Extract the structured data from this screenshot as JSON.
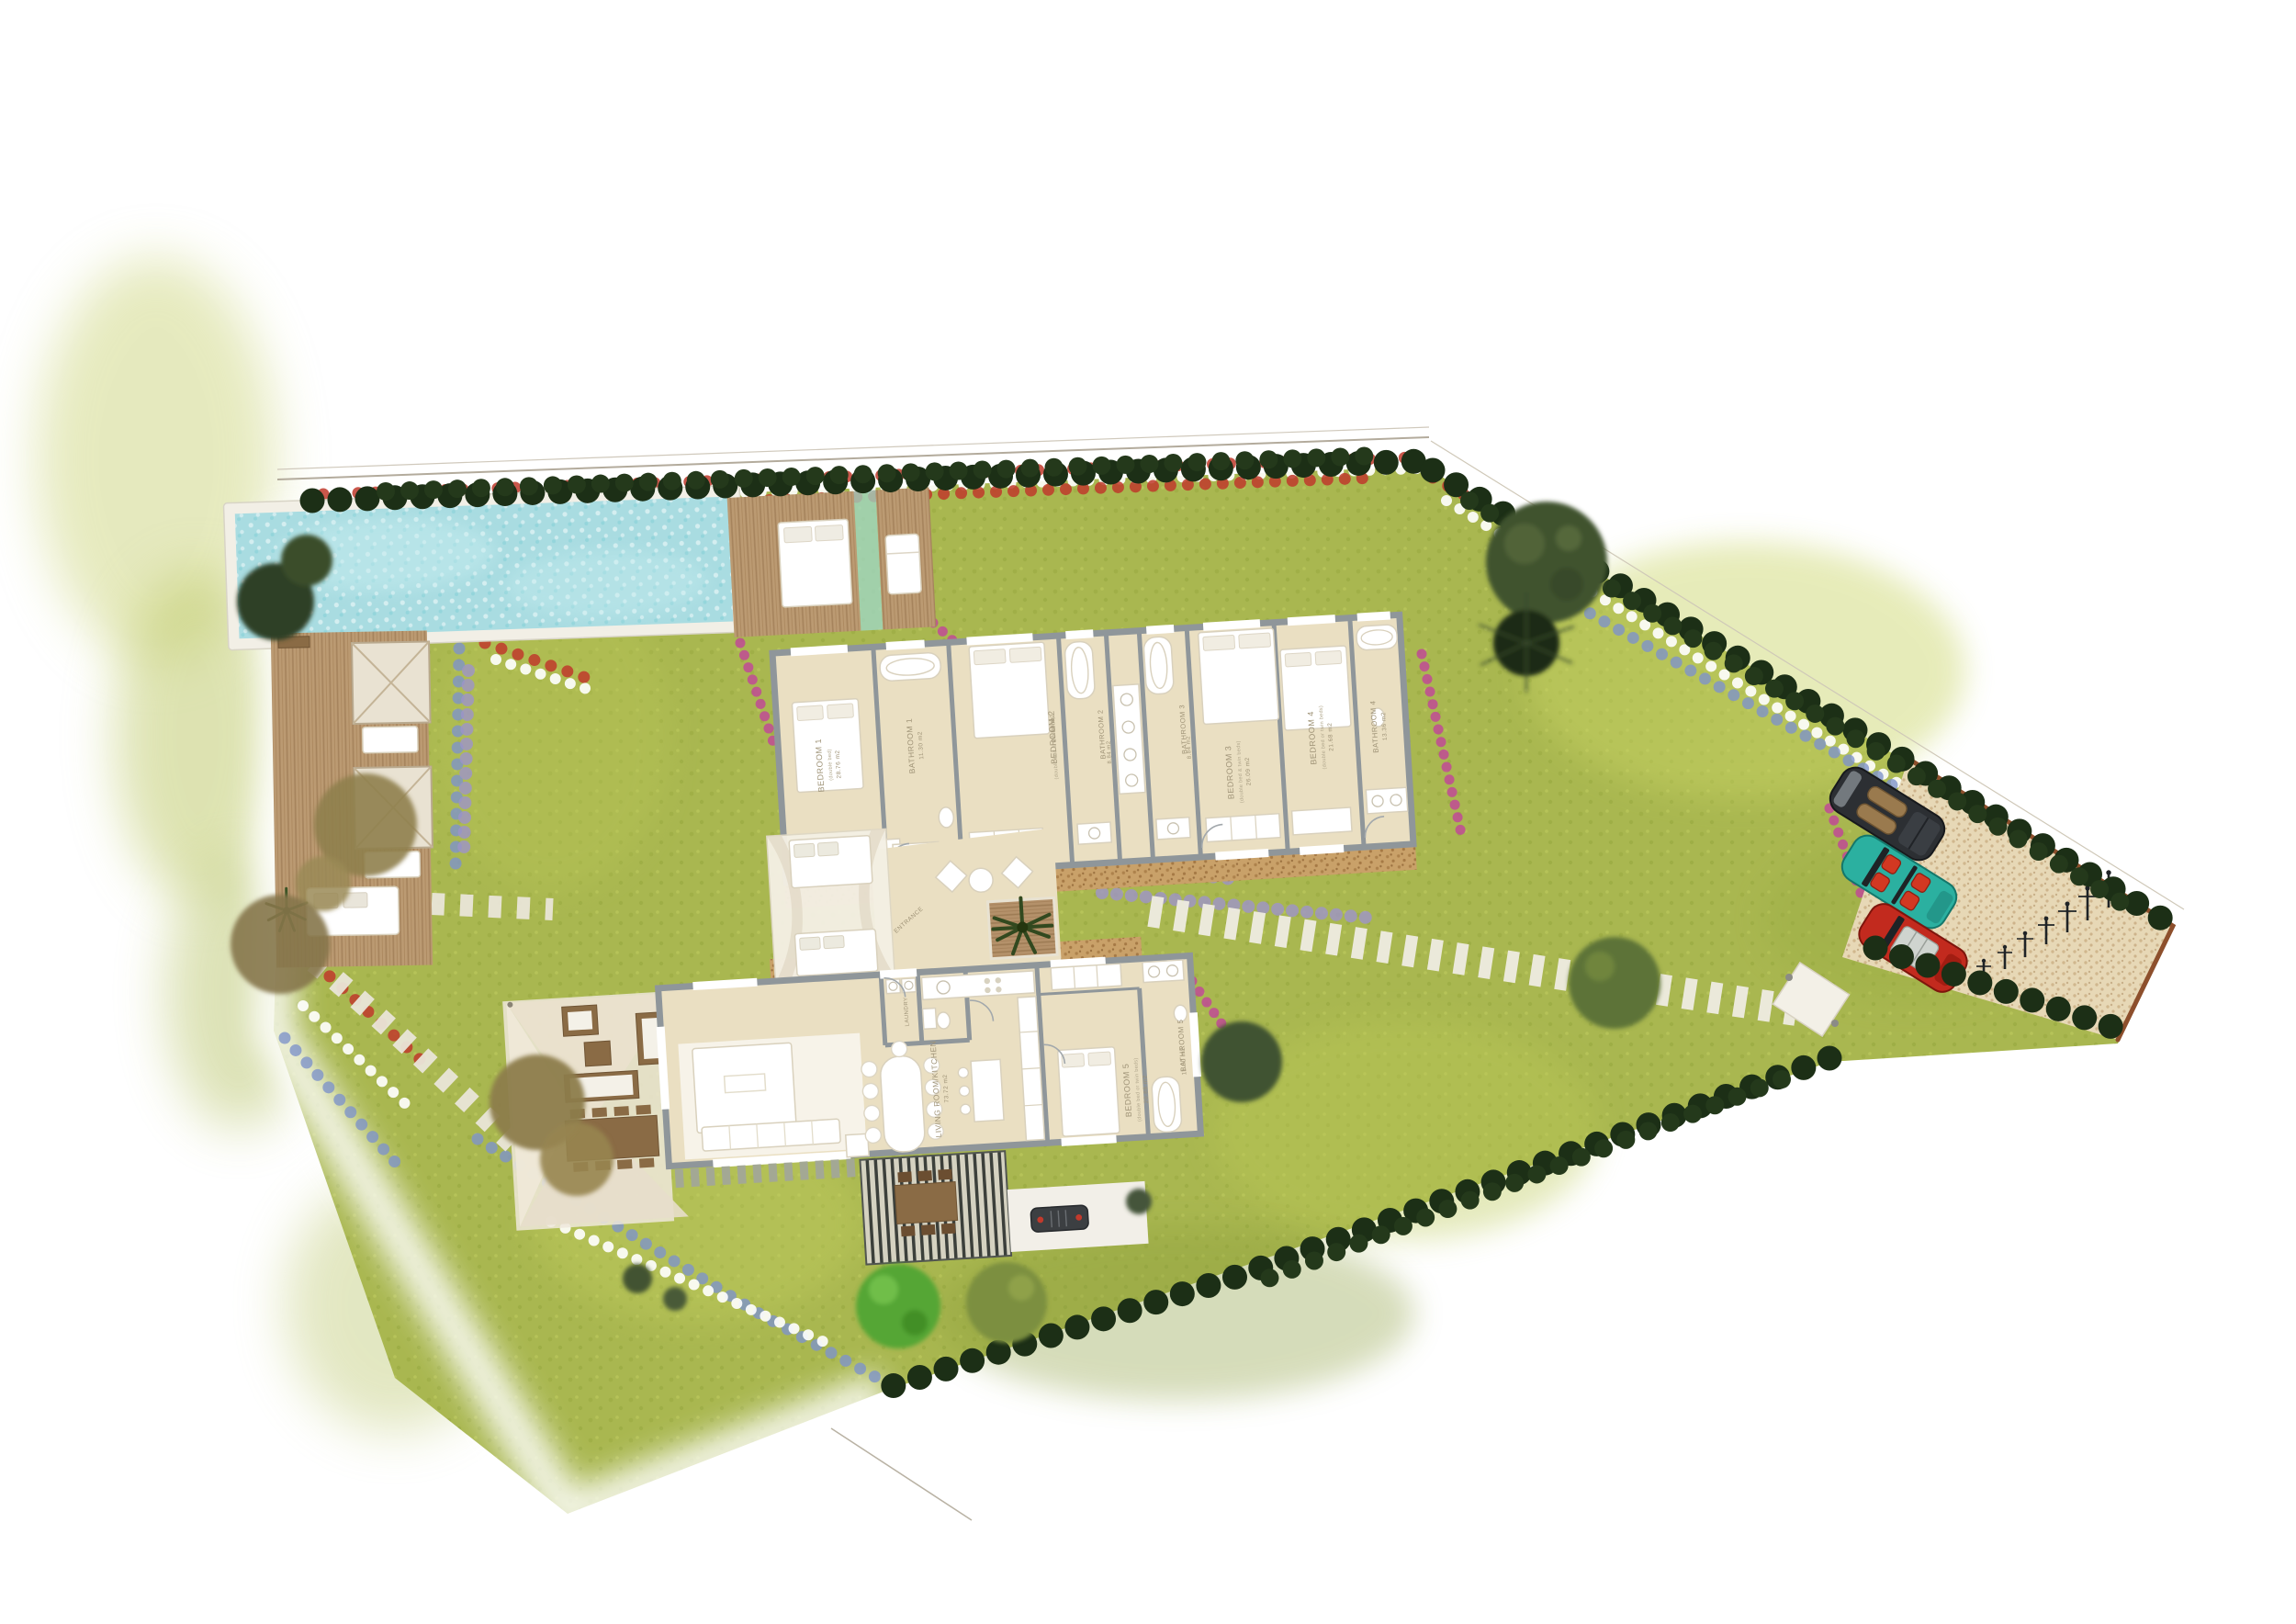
{
  "page": {
    "title": "Villa landscape site plan",
    "background": "#ffffff"
  },
  "plan": {
    "rooms": [
      {
        "id": "bedroom-1",
        "label": "BEDROOM 1",
        "detail": "(double bed)",
        "area": "28.76 m2"
      },
      {
        "id": "bathroom-1",
        "label": "BATHROOM 1",
        "detail": "",
        "area": "11.30 m2"
      },
      {
        "id": "bedroom-2",
        "label": "BEDROOM 2",
        "detail": "(double bed & twin beds)",
        "area": "27.88 m2"
      },
      {
        "id": "bathroom-2",
        "label": "BATHROOM 2",
        "detail": "",
        "area": "8.84 m2"
      },
      {
        "id": "bathroom-3",
        "label": "BATHROOM 3",
        "detail": "",
        "area": "8.84 m2"
      },
      {
        "id": "bedroom-3",
        "label": "BEDROOM 3",
        "detail": "(double bed & twin beds)",
        "area": "26.09 m2"
      },
      {
        "id": "bedroom-4",
        "label": "BEDROOM 4",
        "detail": "(double bed or twin beds)",
        "area": "21.68 m2"
      },
      {
        "id": "bathroom-4",
        "label": "BATHROOM 4",
        "detail": "",
        "area": "13.36 m2"
      },
      {
        "id": "bedroom-5",
        "label": "BEDROOM 5",
        "detail": "(double bed or twin beds)",
        "area": "20.88 m2"
      },
      {
        "id": "bathroom-5",
        "label": "BATHROOM 5",
        "detail": "",
        "area": "11.00 m2"
      },
      {
        "id": "living",
        "label": "LIVING ROOM/KITCHEN",
        "detail": "",
        "area": "73.72 m2"
      },
      {
        "id": "laundry",
        "label": "LAUNDRY",
        "detail": "",
        "area": ""
      },
      {
        "id": "entrance",
        "label": "ENTRANCE",
        "detail": "",
        "area": ""
      }
    ],
    "site_features": [
      "swimming-pool",
      "pool-deck-daybed",
      "sun-deck-cabanas",
      "outdoor-canopy-daybeds",
      "shade-sail-terrace",
      "outdoor-dining-pergola",
      "bbq-area",
      "parking-court",
      "stepping-stone-paths",
      "perimeter-hedge",
      "flower-borders",
      "olive-trees",
      "lawn"
    ],
    "cars": [
      {
        "name": "dark-grey-car",
        "color": "#2c2f33"
      },
      {
        "name": "teal-car",
        "color": "#2bb0a0"
      },
      {
        "name": "red-car",
        "color": "#c22a1e"
      }
    ],
    "colors": {
      "lawn": "#a9b750",
      "pool_water": "#a9dce1",
      "wood_deck": "#bb9a72",
      "floor": "#eadfc2",
      "wall": "#8f969a",
      "hedge": "#1c2f16",
      "label_text": "#9f9377",
      "parking": "#e7d8b6",
      "parking_border": "#8d4f2c"
    }
  }
}
